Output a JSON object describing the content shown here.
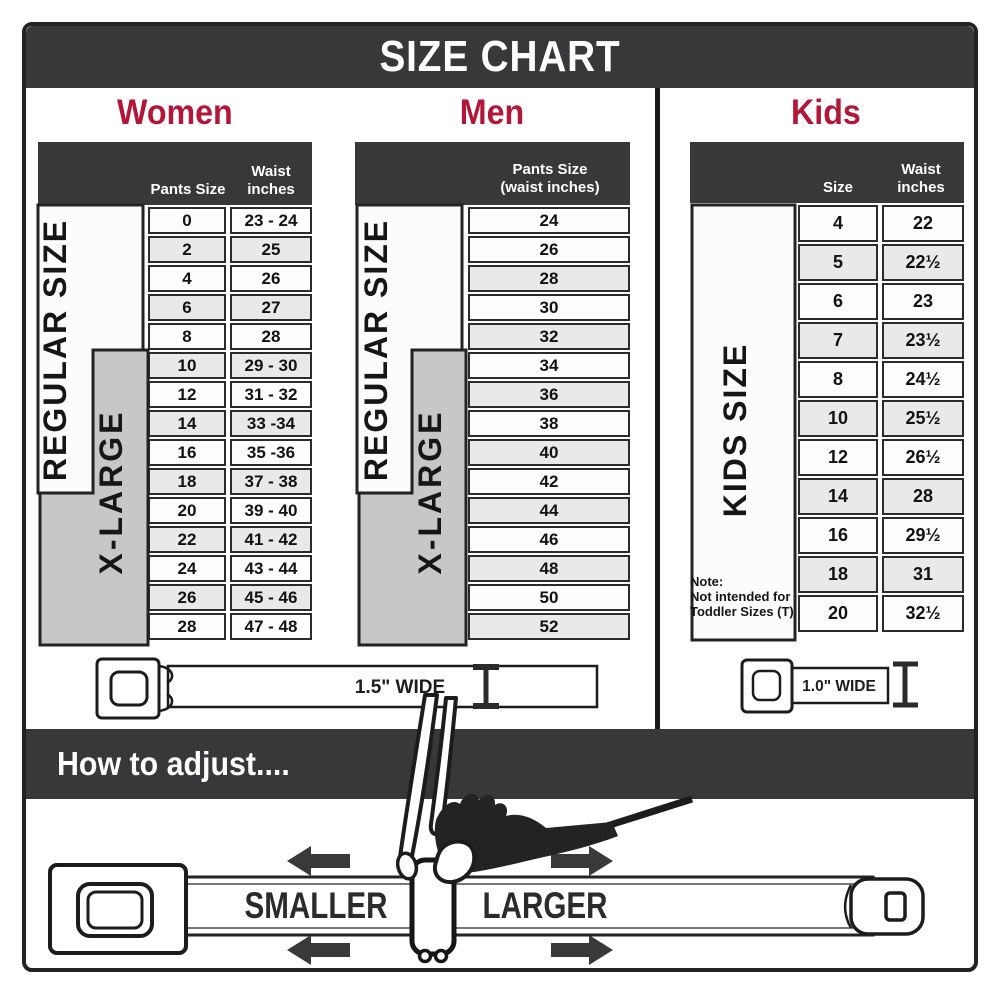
{
  "title": "SIZE CHART",
  "sections": {
    "women": {
      "label": "Women",
      "col1_header": "Pants Size",
      "col2_header_line1": "Waist",
      "col2_header_line2": "inches",
      "regular_label": "REGULAR SIZE",
      "xlarge_label": "X-LARGE",
      "rows": [
        [
          "0",
          "23 - 24"
        ],
        [
          "2",
          "25"
        ],
        [
          "4",
          "26"
        ],
        [
          "6",
          "27"
        ],
        [
          "8",
          "28"
        ],
        [
          "10",
          "29 - 30"
        ],
        [
          "12",
          "31 - 32"
        ],
        [
          "14",
          "33 -34"
        ],
        [
          "16",
          "35 -36"
        ],
        [
          "18",
          "37 - 38"
        ],
        [
          "20",
          "39 - 40"
        ],
        [
          "22",
          "41 - 42"
        ],
        [
          "24",
          "43 - 44"
        ],
        [
          "26",
          "45 - 46"
        ],
        [
          "28",
          "47 - 48"
        ]
      ],
      "belt_width_label": "1.5\" WIDE"
    },
    "men": {
      "label": "Men",
      "header_line1": "Pants Size",
      "header_line2": "(waist inches)",
      "regular_label": "REGULAR SIZE",
      "xlarge_label": "X-LARGE",
      "rows": [
        "24",
        "26",
        "28",
        "30",
        "32",
        "34",
        "36",
        "38",
        "40",
        "42",
        "44",
        "46",
        "48",
        "50",
        "52"
      ]
    },
    "kids": {
      "label": "Kids",
      "col1_header": "Size",
      "col2_header_line1": "Waist",
      "col2_header_line2": "inches",
      "side_label": "KIDS SIZE",
      "note_line1": "Note:",
      "note_line2": "Not intended for",
      "note_line3": "Toddler Sizes (T)",
      "rows": [
        [
          "4",
          "22"
        ],
        [
          "5",
          "22½"
        ],
        [
          "6",
          "23"
        ],
        [
          "7",
          "23½"
        ],
        [
          "8",
          "24½"
        ],
        [
          "10",
          "25½"
        ],
        [
          "12",
          "26½"
        ],
        [
          "14",
          "28"
        ],
        [
          "16",
          "29½"
        ],
        [
          "18",
          "31"
        ],
        [
          "20",
          "32½"
        ]
      ],
      "belt_width_label": "1.0\" WIDE"
    }
  },
  "adjust": {
    "heading": "How to adjust....",
    "smaller_label": "SMALLER",
    "larger_label": "LARGER"
  },
  "colors": {
    "bar_dark": "#37383a",
    "crimson": "#b2173a",
    "row_alt": "#e9e9e9",
    "panel_gray": "#c7c7c7",
    "line": "#232323"
  }
}
